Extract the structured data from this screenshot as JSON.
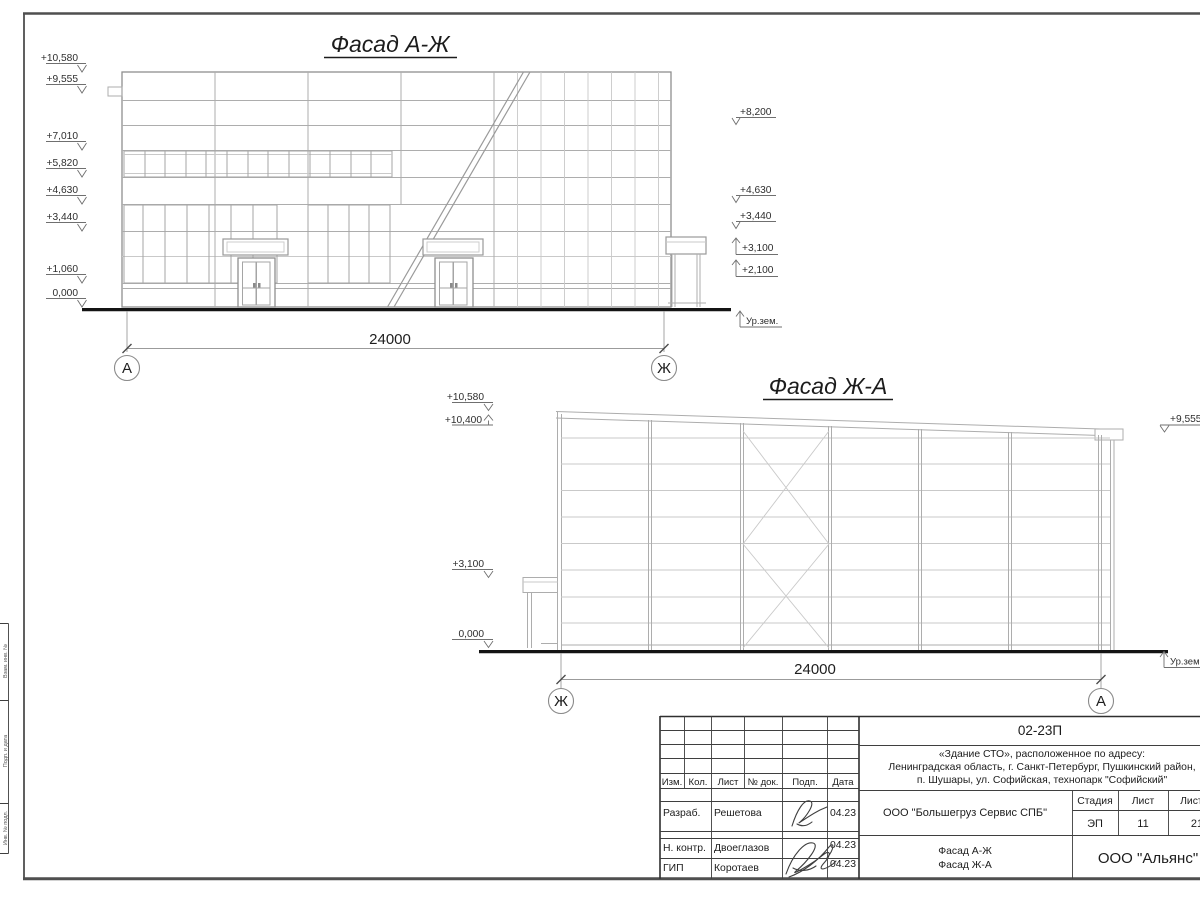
{
  "margin": {
    "side_labels": [
      "Взам. инв. №",
      "Подп. и дата",
      "Инв. № подл."
    ]
  },
  "facade1": {
    "title": "Фасад А-Ж",
    "marks_left": [
      "+10,580",
      "+9,555",
      "+7,010",
      "+5,820",
      "+4,630",
      "+3,440",
      "+1,060",
      "0,000"
    ],
    "marks_right": [
      "+8,200",
      "+4,630",
      "+3,440",
      "+3,100",
      "+2,100"
    ],
    "ground_label": "Ур.зем.",
    "dimension": "24000",
    "axis_left": "А",
    "axis_right": "Ж"
  },
  "facade2": {
    "title": "Фасад Ж-А",
    "marks_left": [
      "+10,580",
      "+10,400",
      "+3,100",
      "0,000"
    ],
    "marks_right": [
      "+9,555"
    ],
    "ground_label": "Ур.зем.",
    "dimension": "24000",
    "axis_left": "Ж",
    "axis_right": "А"
  },
  "titleblock": {
    "doc_code": "02-23П",
    "project_address_lines": [
      "«Здание СТО», расположенное по адресу:",
      "Ленинградская область, г. Санкт-Петербург, Пушкинский район,",
      "п. Шушары, ул. Софийская, технопарк \"Софийский\""
    ],
    "rev_header": [
      "Изм.",
      "Кол.",
      "Лист",
      "№ док.",
      "Подп.",
      "Дата"
    ],
    "signature_rows": [
      {
        "role": "Разраб.",
        "name": "Решетова",
        "date": "04.23"
      },
      {
        "role": "Н. контр.",
        "name": "Двоеглазов",
        "date": "04.23"
      },
      {
        "role": "ГИП",
        "name": "Коротаев",
        "date": "04.23"
      }
    ],
    "client": "ООО \"Большегруз Сервис СПБ\"",
    "drawing_title_lines": [
      "Фасад А-Ж",
      "Фасад Ж-А"
    ],
    "organization": "ООО \"Альянс\"",
    "stage_header": [
      "Стадия",
      "Лист",
      "Листов"
    ],
    "stage": "ЭП",
    "sheet_number": "11",
    "sheets_total": "21"
  }
}
